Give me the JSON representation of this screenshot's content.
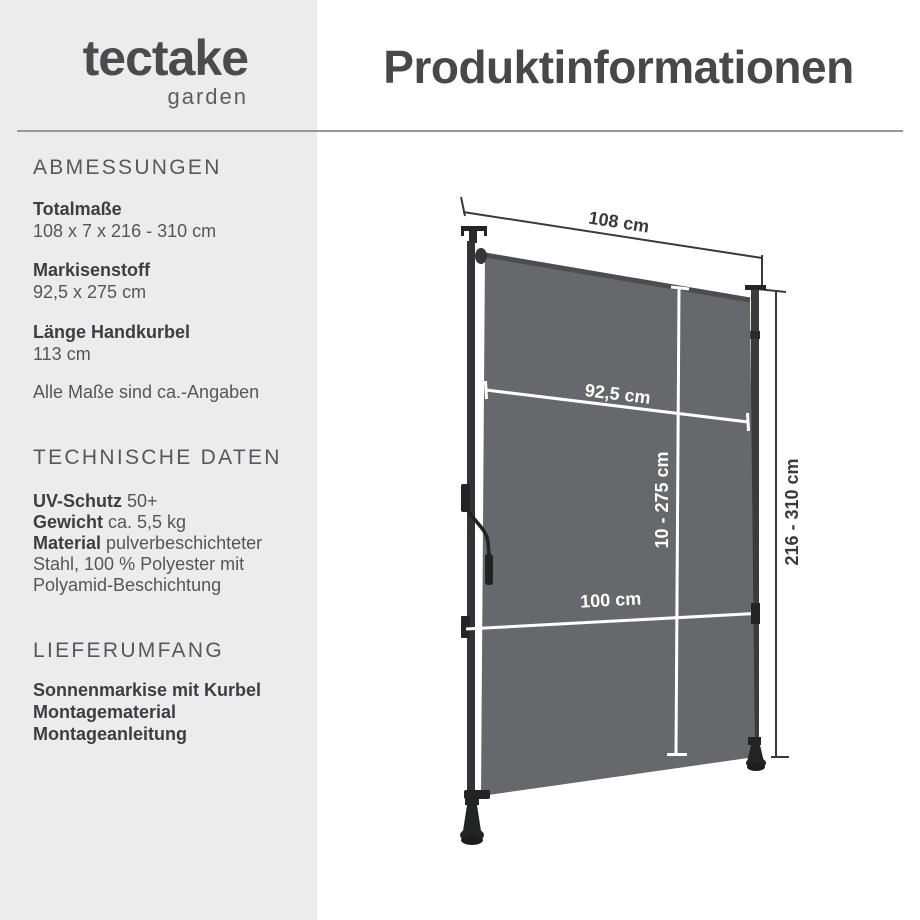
{
  "brand": {
    "name": "tectake",
    "sub": "garden"
  },
  "header": {
    "title": "Produktinformationen"
  },
  "sidebar": {
    "abmessungen": {
      "title": "ABMESSUNGEN",
      "items": [
        {
          "label": "Totalmaße",
          "value": "108 x 7 x 216 - 310 cm"
        },
        {
          "label": "Markisenstoff",
          "value": "92,5 x 275 cm"
        },
        {
          "label": "Länge Handkurbel",
          "value": "113 cm"
        }
      ],
      "note": "Alle Maße sind ca.-Angaben"
    },
    "technische_daten": {
      "title": "TECHNISCHE DATEN",
      "specs": [
        {
          "label": "UV-Schutz",
          "value": " 50+"
        },
        {
          "label": "Gewicht",
          "value": " ca. 5,5 kg"
        },
        {
          "label": "Material",
          "value": " pulverbeschichteter Stahl, 100 % Polyester mit Polyamid-Beschichtung"
        }
      ]
    },
    "lieferumfang": {
      "title": "LIEFERUMFANG",
      "items": [
        "Sonnenmarkise mit Kurbel",
        "Montagematerial",
        "Montageanleitung"
      ]
    }
  },
  "diagram": {
    "total_width": "108 cm",
    "fabric_width": "92,5 cm",
    "extension_range": "10 - 275 cm",
    "pole_distance": "100 cm",
    "height_range": "216 - 310 cm",
    "fabric_color": "#67686c",
    "frame_color": "#2b2c2e",
    "dimension_line_color": "#3a3a3c"
  }
}
